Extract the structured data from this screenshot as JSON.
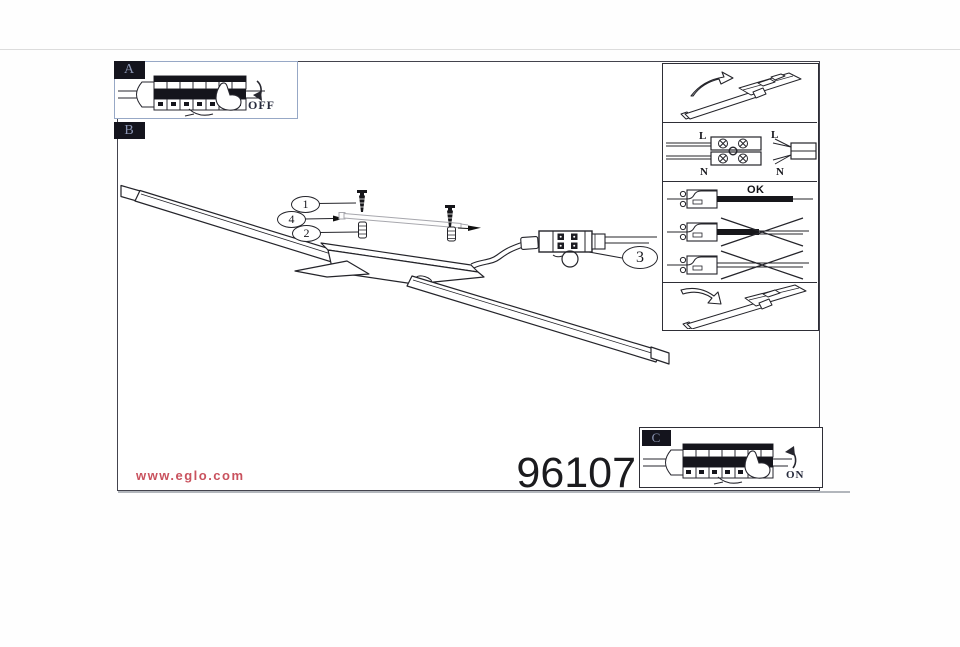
{
  "product": {
    "number": "96107",
    "website": "www.eglo.com"
  },
  "steps": {
    "a": {
      "label": "A",
      "state": "OFF"
    },
    "b": {
      "label": "B"
    },
    "c": {
      "label": "C",
      "state": "ON"
    }
  },
  "callouts": {
    "n1": "1",
    "n2": "2",
    "n3": "3",
    "n4": "4"
  },
  "wiring": {
    "live_left": "L",
    "neutral_left": "N",
    "live_right": "L",
    "neutral_right": "N"
  },
  "clamp": {
    "ok_label": "OK"
  },
  "colors": {
    "accent_red": "#c9525e",
    "ink": "#26262e",
    "label_bg": "#14141d",
    "label_fg": "#8b95b3",
    "box_a_border": "#97a8c6",
    "frame_border": "#43434d"
  }
}
